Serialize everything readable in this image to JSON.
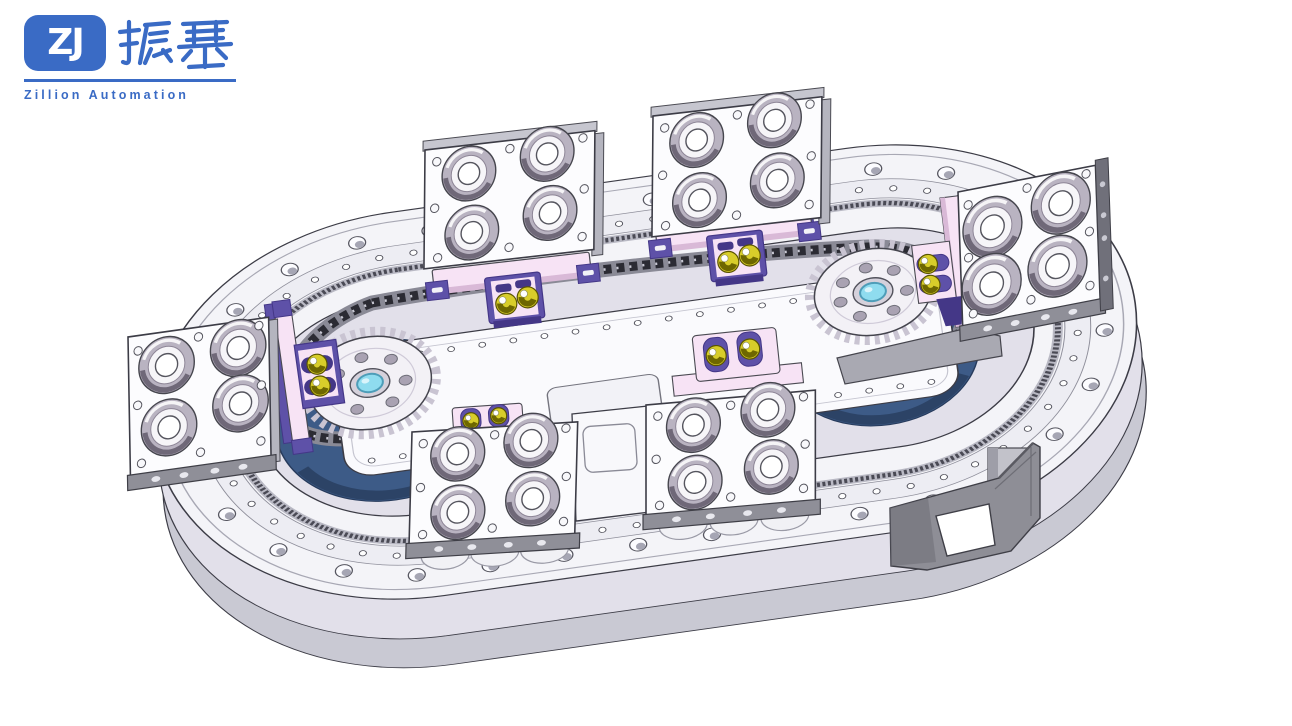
{
  "logo": {
    "badge": "ZJ",
    "cn": "振基",
    "subtitle": "Zillion Automation"
  },
  "colors": {
    "background": "#FFFFFF",
    "outline": "#3C3C46",
    "logo_blue": "#3A6BC5",
    "metal_white": "#F4F4F8",
    "metal_step": "#EDEDF3",
    "metal_side": "#E2E0EA",
    "metal_side_dark": "#C9C9D3",
    "metal_gray": "#8F8F98",
    "plate_white": "#FCFCFE",
    "plate_edge": "#B5B5BF",
    "roller_gray": "#B9B3C1",
    "roller_mid": "#E6E3EA",
    "pink": "#F7E3F5",
    "pink_shade": "#D9B9D7",
    "purple": "#5E51A8",
    "purple_dark": "#443787",
    "yellow": "#D8CD2A",
    "yellow_dark": "#6E6700",
    "chain_dark": "#2B2B33",
    "chain_rail": "#8A8A96",
    "base_blue": "#3D5B87",
    "base_blue_dark": "#2C4366",
    "base_blue_light": "#53719E",
    "hub_cyan": "#8FDCEF",
    "hub_cyan_edge": "#4E9DB8",
    "bracket_gray": "#8E8E96",
    "bracket_dark": "#6E6E76"
  },
  "machine": {
    "type": "3d-cad-render",
    "description": "Oval precision-link indexing conveyor with chain drive and roller carrier plates",
    "parts": [
      {
        "id": "base-ring",
        "label": "Oval base ring with countersunk bolt holes",
        "count": 1
      },
      {
        "id": "guide-rail",
        "label": "Inner guide rail with dense bolt-hole row",
        "count": 1
      },
      {
        "id": "drive-chain",
        "label": "Roller chain loop",
        "count": 1
      },
      {
        "id": "sprocket",
        "label": "Drive sprocket with cyan hub",
        "count": 2
      },
      {
        "id": "turret-base",
        "label": "Dark blue turret base under sprocket",
        "count": 2
      },
      {
        "id": "bearing-plate",
        "label": "Carrier plate with four bearing rollers",
        "count": 6
      },
      {
        "id": "cam-carriage",
        "label": "Pink carriage with yellow cam followers",
        "count": 6
      },
      {
        "id": "center-platform",
        "label": "Central mounting platform with hole rows",
        "count": 1
      },
      {
        "id": "support-bracket",
        "label": "Gray mounting stand with square cutout",
        "count": 1
      },
      {
        "id": "motor-housing",
        "label": "Motor housing cylinder",
        "count": 1
      }
    ]
  }
}
